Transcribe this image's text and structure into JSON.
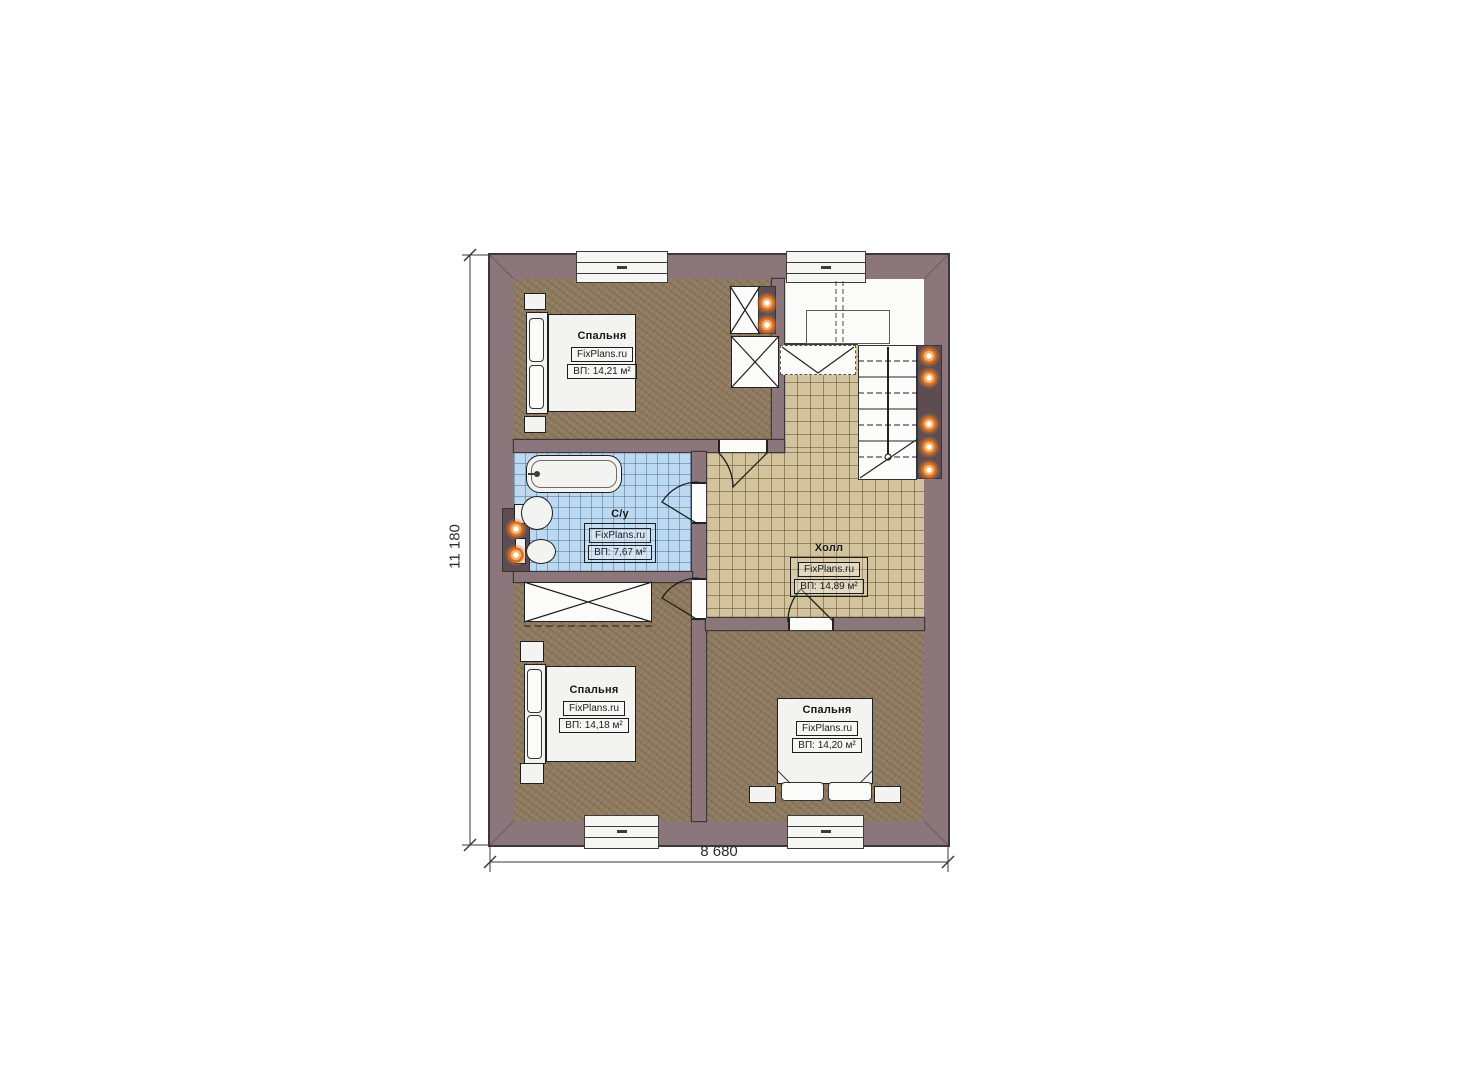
{
  "plan": {
    "dimensions": {
      "height_label": "11 180",
      "width_label": "8 680"
    },
    "rooms": [
      {
        "id": "bedroom-top",
        "name": "Спальня",
        "watermark": "FixPlans.ru",
        "area": "ВП: 14,21 м²"
      },
      {
        "id": "bathroom",
        "name": "С/у",
        "watermark": "FixPlans.ru",
        "area": "ВП: 7,67 м²"
      },
      {
        "id": "hall",
        "name": "Холл",
        "watermark": "FixPlans.ru",
        "area": "ВП: 14,89 м²"
      },
      {
        "id": "bedroom-bottom-left",
        "name": "Спальня",
        "watermark": "FixPlans.ru",
        "area": "ВП: 14,18 м²"
      },
      {
        "id": "bedroom-bottom-right",
        "name": "Спальня",
        "watermark": "FixPlans.ru",
        "area": "ВП: 14,20 м²"
      }
    ],
    "colors": {
      "wall": "#8b767b",
      "wall_outline": "#3e373a",
      "bedroom_floor": "#8e7b60",
      "hall_tile": "#d3c39c",
      "bath_tile": "#bcd9f1",
      "fixture": "#f3f3f1",
      "light": "#de7828",
      "recess": "#5d4d52"
    }
  }
}
